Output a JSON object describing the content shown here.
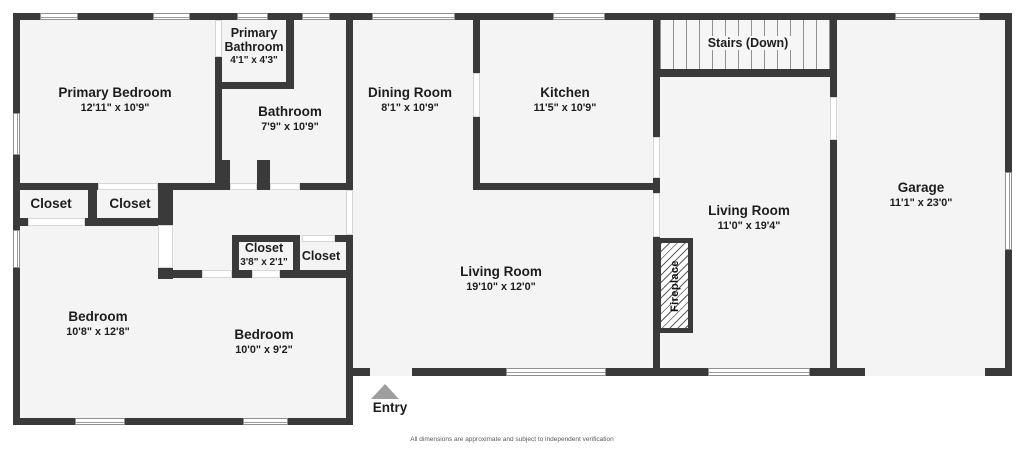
{
  "floorplan": {
    "rooms": [
      {
        "name": "Primary Bedroom",
        "dims": "12'11\" x 10'9\""
      },
      {
        "name": "Primary Bathroom",
        "dims": "4'1\" x 4'3\""
      },
      {
        "name": "Bathroom",
        "dims": "7'9\" x 10'9\""
      },
      {
        "name": "Dining Room",
        "dims": "8'1\" x 10'9\""
      },
      {
        "name": "Kitchen",
        "dims": "11'5\" x 10'9\""
      },
      {
        "name": "Stairs (Down)",
        "dims": ""
      },
      {
        "name": "Garage",
        "dims": "11'1\" x 23'0\""
      },
      {
        "name": "Living Room",
        "dims": "11'0\" x 19'4\""
      },
      {
        "name": "Living Room",
        "dims": "19'10\" x 12'0\""
      },
      {
        "name": "Closet",
        "dims": ""
      },
      {
        "name": "Closet",
        "dims": ""
      },
      {
        "name": "Closet",
        "dims": "3'8\" x 2'1\""
      },
      {
        "name": "Closet",
        "dims": ""
      },
      {
        "name": "Bedroom",
        "dims": "10'8\" x 12'8\""
      },
      {
        "name": "Bedroom",
        "dims": "10'0\" x 9'2\""
      }
    ],
    "fireplace_label": "Fireplace",
    "entry_label": "Entry",
    "disclaimer": "All dimensions are approximate and subject to independent verification",
    "colors": {
      "wall": "#3a3a3a",
      "room_fill": "#f4f4f4",
      "entry_marker": "#9e9e9e"
    }
  }
}
